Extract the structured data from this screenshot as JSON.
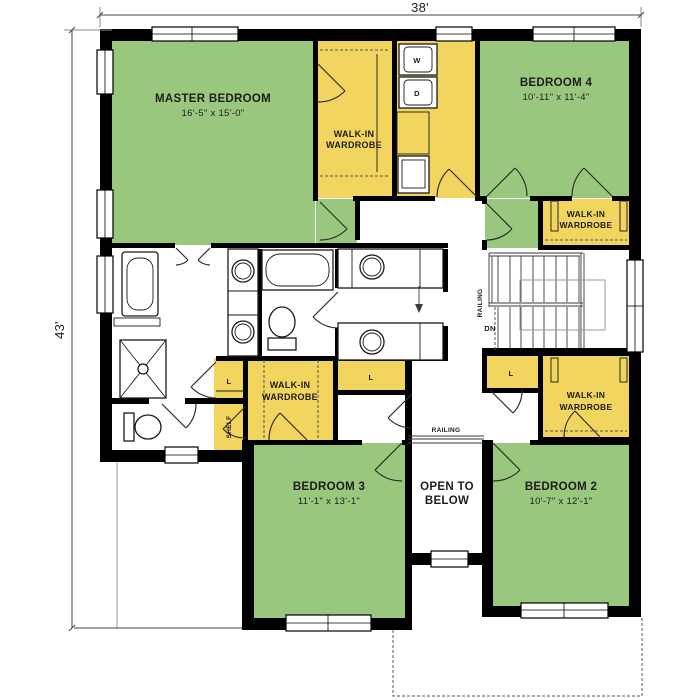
{
  "plan": {
    "overall_width": "38'",
    "overall_depth": "43'",
    "rooms": {
      "master_bedroom": {
        "name": "MASTER BEDROOM",
        "dims": "16'-5\" x 15'-0\""
      },
      "bedroom4": {
        "name": "BEDROOM 4",
        "dims": "10'-11\" x 11'-4\""
      },
      "bedroom3": {
        "name": "BEDROOM 3",
        "dims": "11'-1\" x 13'-1\""
      },
      "bedroom2": {
        "name": "BEDROOM 2",
        "dims": "10'-7\" x 12'-1\""
      },
      "open_to_below": {
        "line1": "OPEN TO",
        "line2": "BELOW"
      }
    },
    "closets": {
      "walk_in_line1": "WALK-IN",
      "walk_in_line2": "WARDROBE",
      "linen": "L",
      "shelf": "SHELF"
    },
    "labels": {
      "washer": "W",
      "dryer": "D",
      "down": "DN",
      "railing": "RAILING"
    },
    "colors": {
      "bedroom_fill": "#9ac77e",
      "closet_fill": "#f1d55f",
      "wall": "#000000"
    }
  }
}
